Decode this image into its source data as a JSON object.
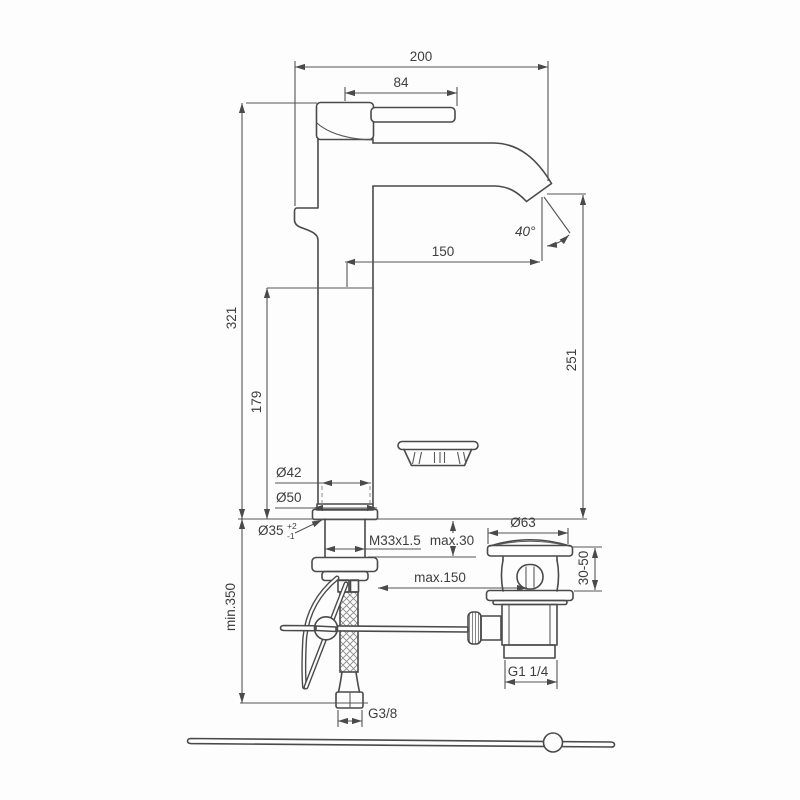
{
  "drawing": {
    "type": "faucet-installation-technical-drawing",
    "background_color": "#fdfdfd",
    "outline_color": "#4a4a4a",
    "dimension_line_color": "#555555",
    "text_color": "#3e3e3e",
    "dimensions": {
      "overall_width": "200",
      "handle_length": "84",
      "spout_reach": "150",
      "spout_angle": "40°",
      "total_height": "321",
      "outlet_height": "179",
      "spout_to_deck": "251",
      "min_clearance": "min.350",
      "body_diameter": "Ø42",
      "base_diameter": "Ø50",
      "hole_diameter": "Ø35",
      "hole_tol_plus": "+2",
      "hole_tol_minus": "-1",
      "shank_thread": "M33x1.5",
      "deck_thickness": "max.30",
      "waste_distance": "max.150",
      "waste_flange_diameter": "Ø63",
      "waste_clamp_range": "30-50",
      "waste_thread": "G1 1/4",
      "supply_thread": "G3/8"
    }
  }
}
